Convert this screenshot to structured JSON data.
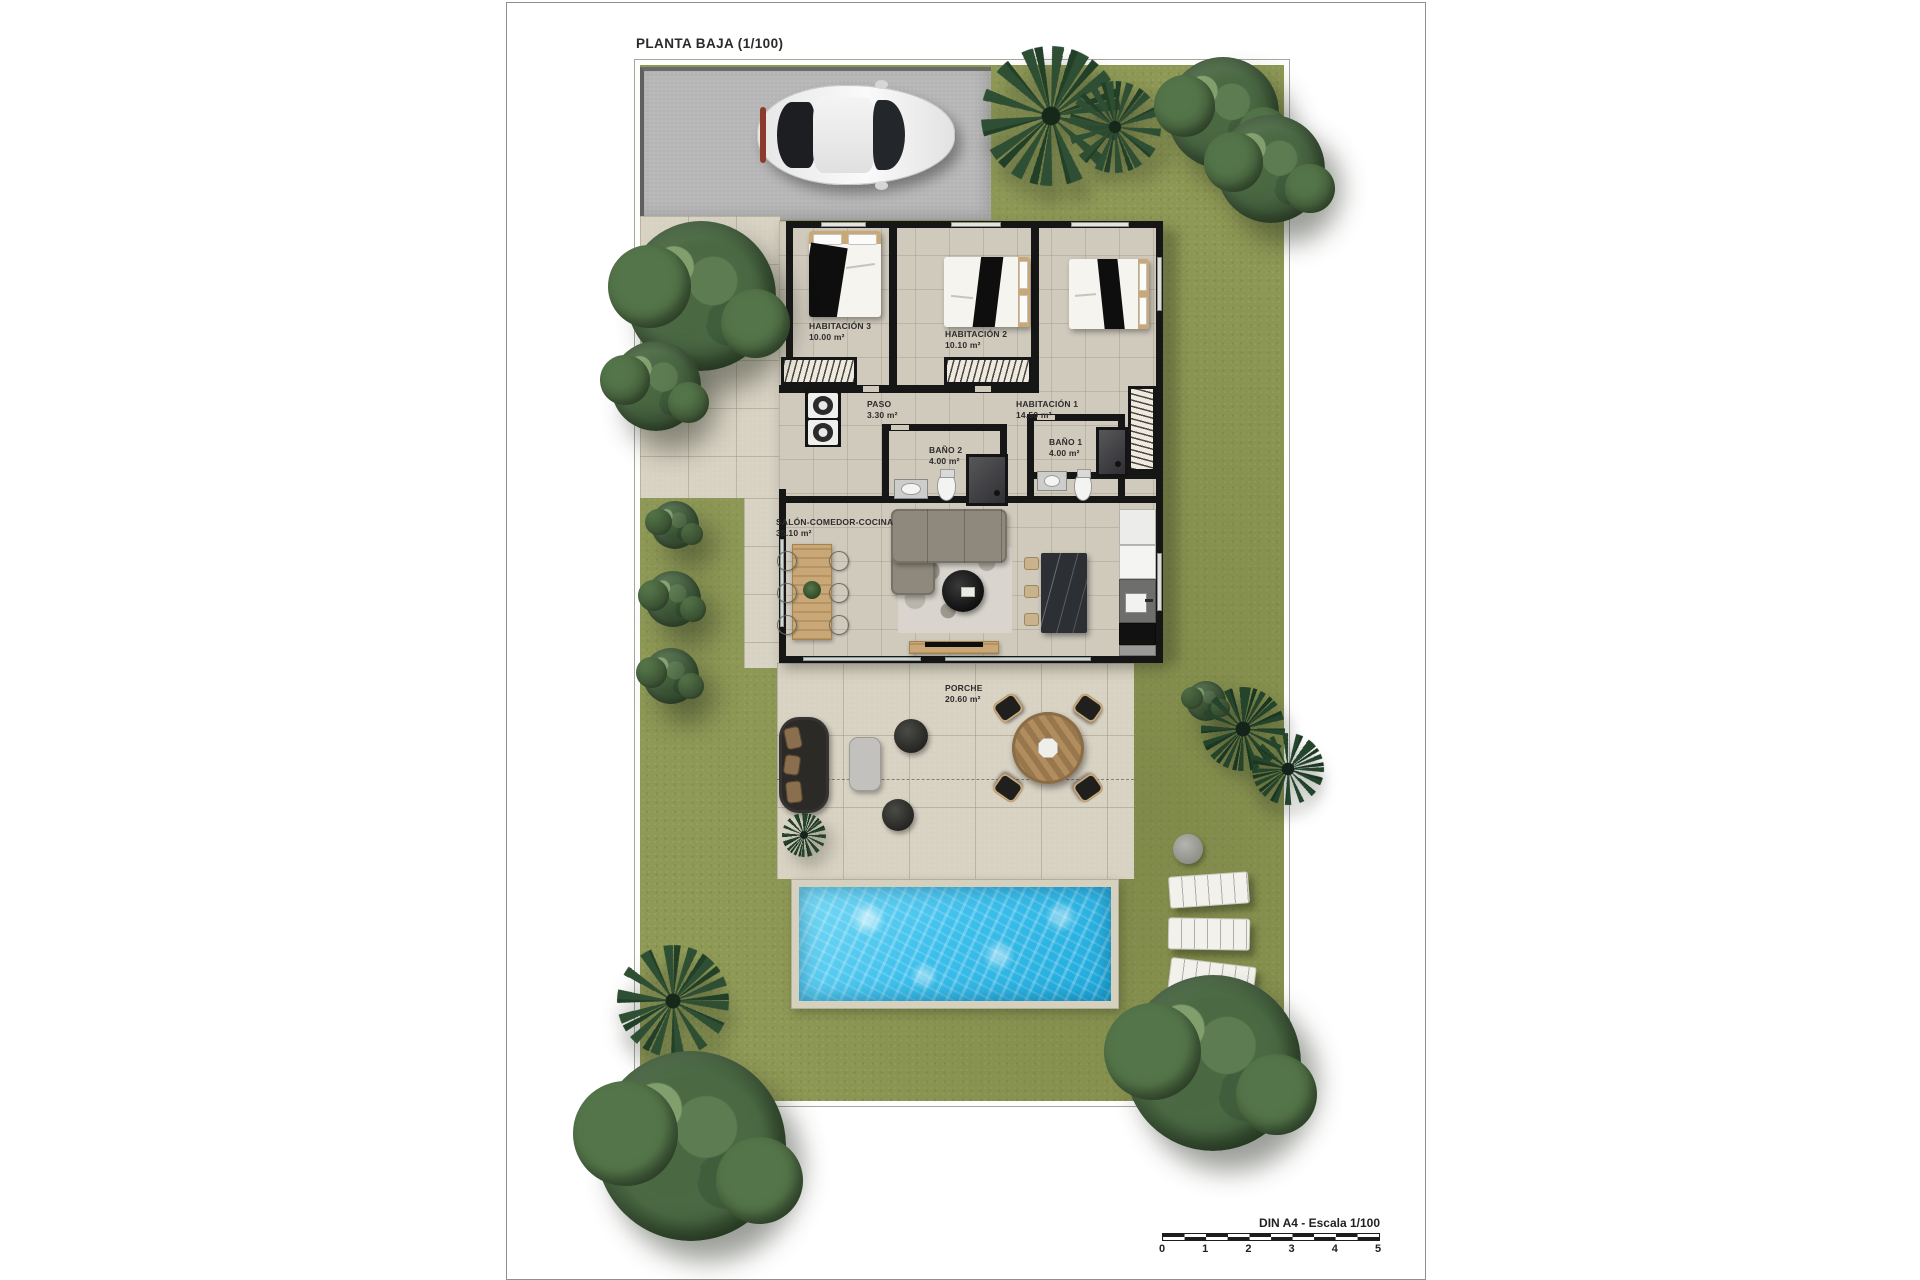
{
  "sheet": {
    "title": "PLANTA BAJA (1/100)"
  },
  "rooms": [
    {
      "label": "HABITACIÓN 3",
      "area": "10.00 m²"
    },
    {
      "label": "HABITACIÓN 2",
      "area": "10.10 m²"
    },
    {
      "label": "HABITACIÓN 1",
      "area": "14.50 m²"
    },
    {
      "label": "PASO",
      "area": "3.30 m²"
    },
    {
      "label": "BAÑO 2",
      "area": "4.00 m²"
    },
    {
      "label": "BAÑO 1",
      "area": "4.00 m²"
    },
    {
      "label": "SALÓN-COMEDOR-COCINA",
      "area": "35.10 m²"
    },
    {
      "label": "PORCHE",
      "area": "20.60 m²"
    }
  ],
  "scale_bar": {
    "label": "DIN A4 - Escala 1/100",
    "ticks": [
      "0",
      "1",
      "2",
      "3",
      "4",
      "5"
    ]
  },
  "colors": {
    "grass": "#8e9955",
    "pavement": "#d8d2c3",
    "floor": "#d0cabd",
    "wall": "#161616",
    "driveway": "#b6b6b6",
    "pool": "#3fc0ec",
    "pool_light": "#7edcf6",
    "pool_deep": "#1da8da",
    "wood": "#c9a777",
    "tree": "#4b6a44",
    "palm": "#2e4f33"
  }
}
